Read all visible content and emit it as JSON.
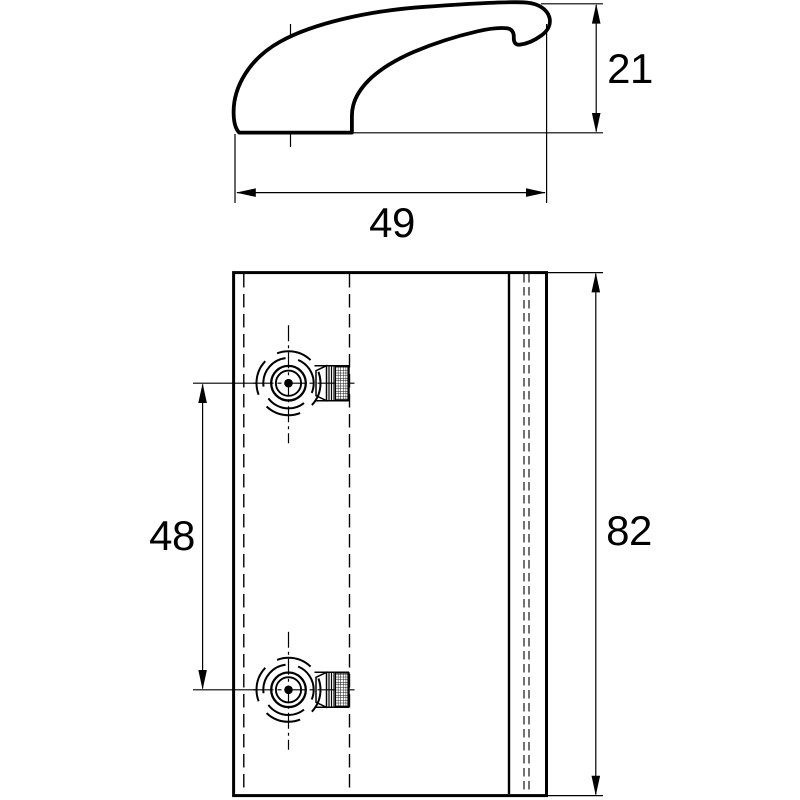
{
  "drawing": {
    "background_color": "#ffffff",
    "line_color": "#000000",
    "views": {
      "handle_profile": {
        "dimensions": {
          "height": "21",
          "length": "49"
        }
      },
      "plate_front": {
        "dimensions": {
          "hole_spacing": "48",
          "height": "82"
        }
      }
    }
  }
}
